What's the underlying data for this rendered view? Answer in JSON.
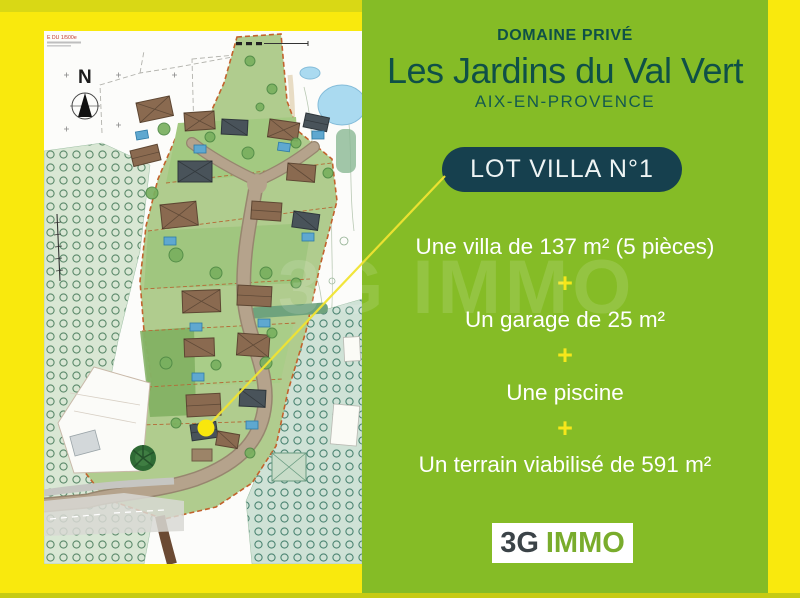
{
  "colors": {
    "yellow": "#F9E90D",
    "olive": "#D9D815",
    "olive2": "#C6CB13",
    "green": "#85BC26",
    "teal": "#0F5047",
    "badge": "#16404E",
    "plus": "#F6E71A",
    "white": "#FFFFFF",
    "logo-gray": "#3B4348",
    "logo-green": "#79AC2C"
  },
  "map": {
    "plan_ref": "E DU 1/500e",
    "compass_n": "N"
  },
  "panel": {
    "kicker": "DOMAINE PRIVÉ",
    "title": "Les Jardins du Val Vert",
    "subtitle": "AIX-EN-PROVENCE",
    "badge": "LOT VILLA N°1",
    "separator": "+",
    "features": [
      "Une villa de 137 m² (5 pièces)",
      "Un garage de 25 m²",
      "Une piscine",
      "Un terrain viabilisé de 591 m²"
    ],
    "logo": {
      "prefix": "3G",
      "suffix": "IMMO"
    },
    "watermark": "3G IMMO"
  }
}
